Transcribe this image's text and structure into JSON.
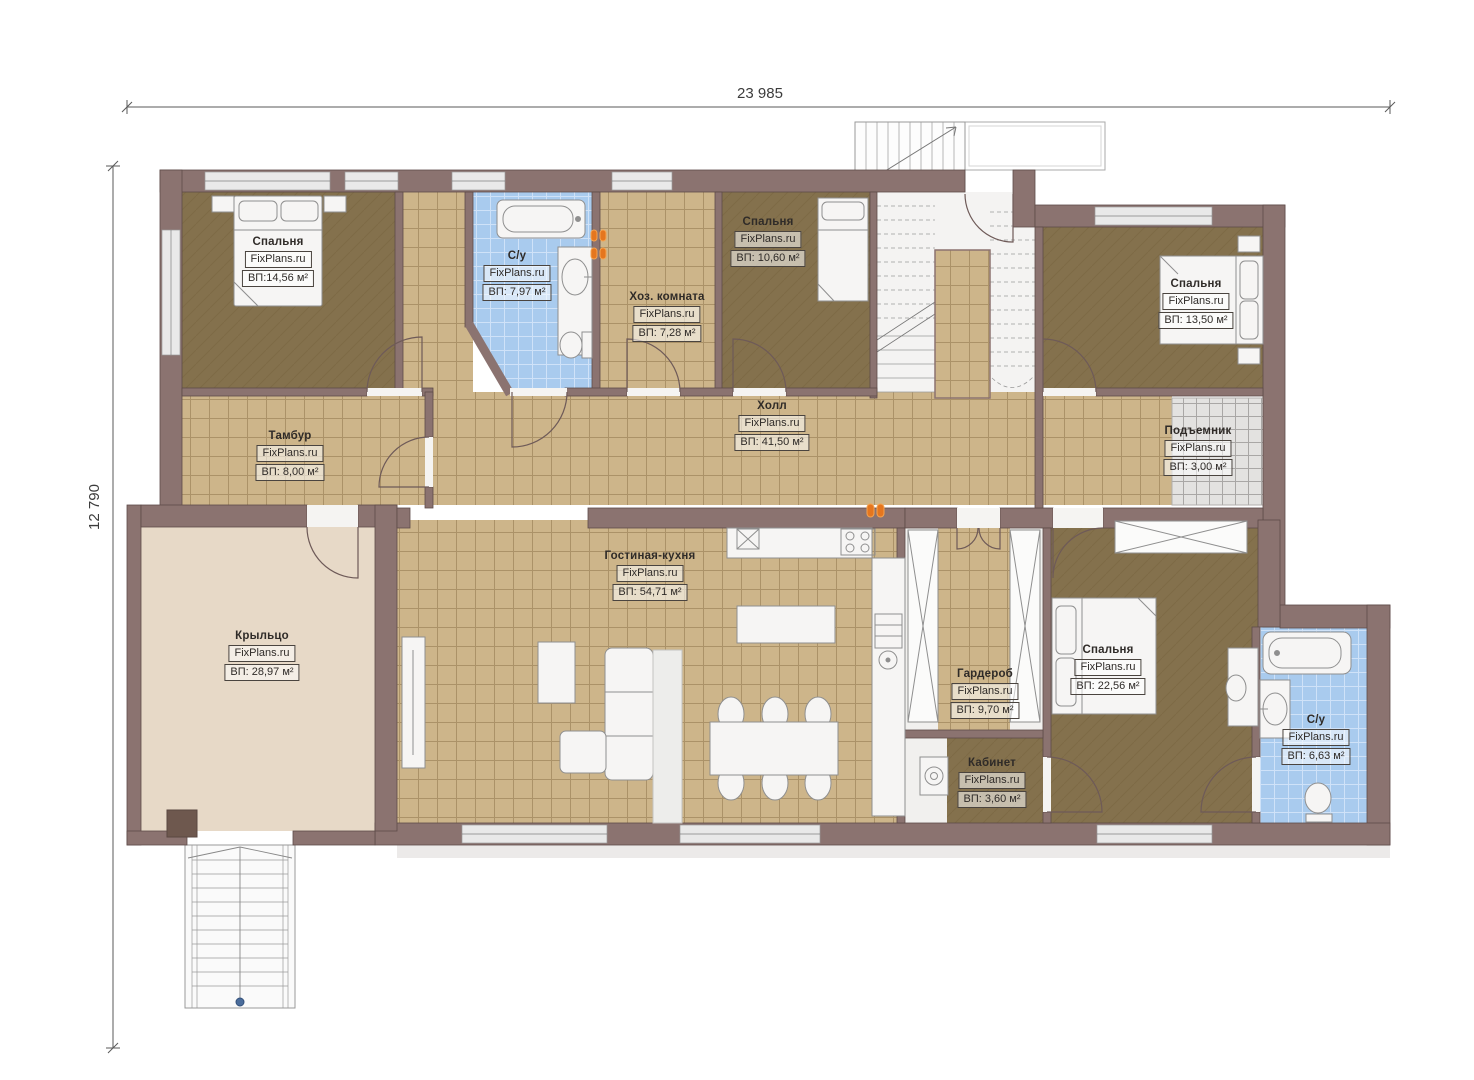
{
  "branding": {
    "watermark": "FixPlans.ru"
  },
  "dims": {
    "width": "23 985",
    "height": "12 790"
  },
  "rooms": [
    {
      "name": "Спальня",
      "area": "ВП:14,56 м²"
    },
    {
      "name": "С/у",
      "area": "ВП: 7,97 м²"
    },
    {
      "name": "Хоз. комната",
      "area": "ВП: 7,28 м²"
    },
    {
      "name": "Спальня",
      "area": "ВП: 10,60 м²"
    },
    {
      "name": "Спальня",
      "area": "ВП: 13,50 м²"
    },
    {
      "name": "Тамбур",
      "area": "ВП: 8,00 м²"
    },
    {
      "name": "Холл",
      "area": "ВП: 41,50 м²"
    },
    {
      "name": "Подъемник",
      "area": "ВП: 3,00 м²"
    },
    {
      "name": "Гостиная-кухня",
      "area": "ВП: 54,71 м²"
    },
    {
      "name": "Крыльцо",
      "area": "ВП: 28,97 м²"
    },
    {
      "name": "Гардероб",
      "area": "ВП: 9,70 м²"
    },
    {
      "name": "Спальня",
      "area": "ВП: 22,56 м²"
    },
    {
      "name": "Кабинет",
      "area": "ВП: 3,60 м²"
    },
    {
      "name": "С/у",
      "area": "ВП: 6,63 м²"
    }
  ],
  "colors": {
    "wall": "#8b7370",
    "floor_wood_dark": "#84714d",
    "floor_tile_tan": "#cdb58a",
    "floor_tile_blue": "#a9cbee",
    "floor_porch": "#e7d9c7",
    "lift_grid": "#e3e2e0",
    "accent_orange": "#e5761e",
    "dimension_line": "#5a5a5a"
  }
}
